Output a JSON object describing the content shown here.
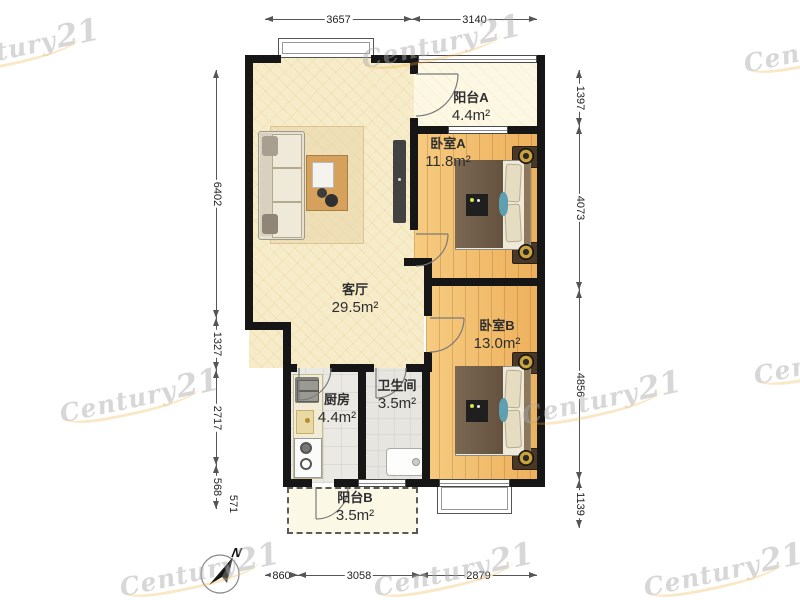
{
  "watermark": {
    "brand_primary": "Century",
    "brand_number": "21"
  },
  "compass": {
    "label": "N"
  },
  "rooms": [
    {
      "id": "balcony-a",
      "name": "阳台A",
      "area": "4.4m²"
    },
    {
      "id": "bedroom-a",
      "name": "卧室A",
      "area": "11.8m²"
    },
    {
      "id": "living-room",
      "name": "客厅",
      "area": "29.5m²"
    },
    {
      "id": "bedroom-b",
      "name": "卧室B",
      "area": "13.0m²"
    },
    {
      "id": "kitchen",
      "name": "厨房",
      "area": "4.4m²"
    },
    {
      "id": "bathroom",
      "name": "卫生间",
      "area": "3.5m²"
    },
    {
      "id": "balcony-b",
      "name": "阳台B",
      "area": "3.5m²"
    }
  ],
  "dimensions": {
    "top": [
      "3657",
      "3140"
    ],
    "bottom": [
      "860",
      "3058",
      "2879"
    ],
    "left": [
      "6402",
      "1327",
      "2717",
      "568",
      "571"
    ],
    "right": [
      "1397",
      "4073",
      "4856",
      "1139"
    ]
  }
}
